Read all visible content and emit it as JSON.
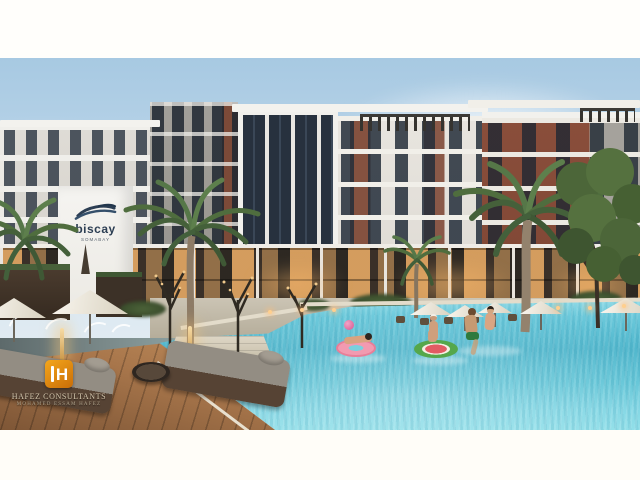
{
  "frame": {
    "width": 640,
    "height": 480,
    "letterbox_color": "#ffffff"
  },
  "brand": {
    "name": "biscay",
    "tagline": "SOMABAY",
    "logo_navy": "#2c3e53"
  },
  "watermark": {
    "monogram": "H",
    "firm": "HAFEZ CONSULTANTS",
    "person": "MOHAMED ESSAM HAFEZ",
    "logo_orange": "#e0890f"
  },
  "palette": {
    "sky_top": "#a7c9e2",
    "sky_horizon": "#edf2f4",
    "pool_water": "#52b8ce",
    "brick": "#8a4f3c",
    "facade_white": "#efeeea",
    "wood_deck": "#a0714a",
    "umbrella_white": "#f4f0e6",
    "palm_green": "#567748",
    "warm_interior_light": "#f0b067"
  },
  "inventory": {
    "umbrellas": 8,
    "palm_trees": 5,
    "pool_floats": 2,
    "swimmers": 5,
    "daybeds": 3,
    "string_light_trees": 3,
    "fountain_jets": 4
  }
}
